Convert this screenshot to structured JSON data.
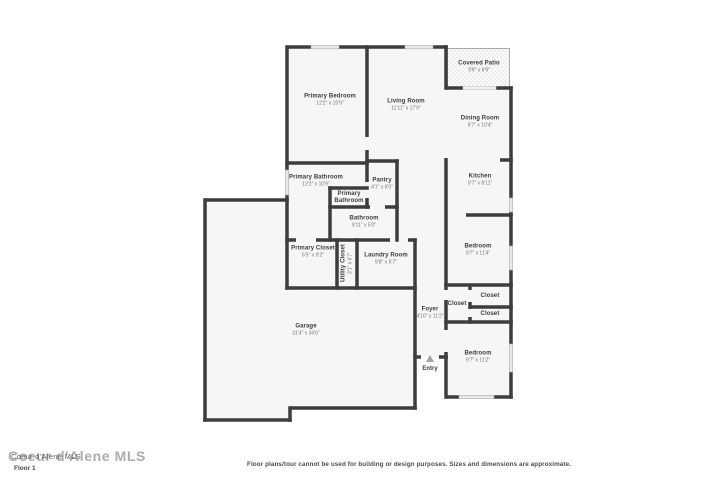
{
  "title": "Floor plan",
  "floor_label": "Floor 1",
  "disclaimer": "Floor plans/tour cannot be used for building or design purposes. Sizes and dimensions are approximate.",
  "watermark": {
    "large": "Coeur d'Alene MLS",
    "small": "Coeur d'Alene MLS"
  },
  "colors": {
    "wall": "#3d3d3d",
    "floor_fill": "#f6f6f6",
    "window": "#e9e9e9",
    "window_border": "#b0b0b0",
    "patio_border": "#a8a8a8",
    "room_name_text": "#3c3c3c",
    "room_dims_text": "#757575",
    "entry_marker": "#a3a3a3"
  },
  "entry_marker_icon": "triangle-up",
  "rooms": [
    {
      "id": "primary-bedroom",
      "name": "Primary Bedroom",
      "dims": "12'2\" x 15'9\""
    },
    {
      "id": "living-room",
      "name": "Living Room",
      "dims": "11'11\" x 17'9\""
    },
    {
      "id": "covered-patio",
      "name": "Covered Patio",
      "dims": "9'9\" x 6'9\""
    },
    {
      "id": "dining-room",
      "name": "Dining Room",
      "dims": "9'7\" x 10'4\""
    },
    {
      "id": "kitchen",
      "name": "Kitchen",
      "dims": "9'7\" x 8'11\""
    },
    {
      "id": "primary-bathroom",
      "name": "Primary Bathroom",
      "dims": "12'2\" x 10'9\""
    },
    {
      "id": "pantry",
      "name": "Pantry",
      "dims": "4'1\" x 6'0\""
    },
    {
      "id": "primary-bathroom-small",
      "name": "Primary Bathroom",
      "dims": ""
    },
    {
      "id": "bathroom",
      "name": "Bathroom",
      "dims": "9'11\" x 5'0\""
    },
    {
      "id": "primary-closet",
      "name": "Primary Closet",
      "dims": "6'5\" x 9'2\""
    },
    {
      "id": "utility-closet",
      "name": "Utility Closet",
      "dims": "3'1\" x 6'7\""
    },
    {
      "id": "laundry-room",
      "name": "Laundry Room",
      "dims": "9'8\" x 6'7\""
    },
    {
      "id": "bedroom-upper",
      "name": "Bedroom",
      "dims": "9'7\" x 11'4\""
    },
    {
      "id": "closet-hall",
      "name": "Closet",
      "dims": ""
    },
    {
      "id": "closet-top",
      "name": "Closet",
      "dims": ""
    },
    {
      "id": "closet-bottom",
      "name": "Closet",
      "dims": ""
    },
    {
      "id": "foyer",
      "name": "Foyer",
      "dims": "4'10\" x 11'2\""
    },
    {
      "id": "bedroom-lower",
      "name": "Bedroom",
      "dims": "9'7\" x 11'2\""
    },
    {
      "id": "garage",
      "name": "Garage",
      "dims": "31'4\" x 34'6\""
    },
    {
      "id": "entry",
      "name": "Entry",
      "dims": ""
    }
  ]
}
